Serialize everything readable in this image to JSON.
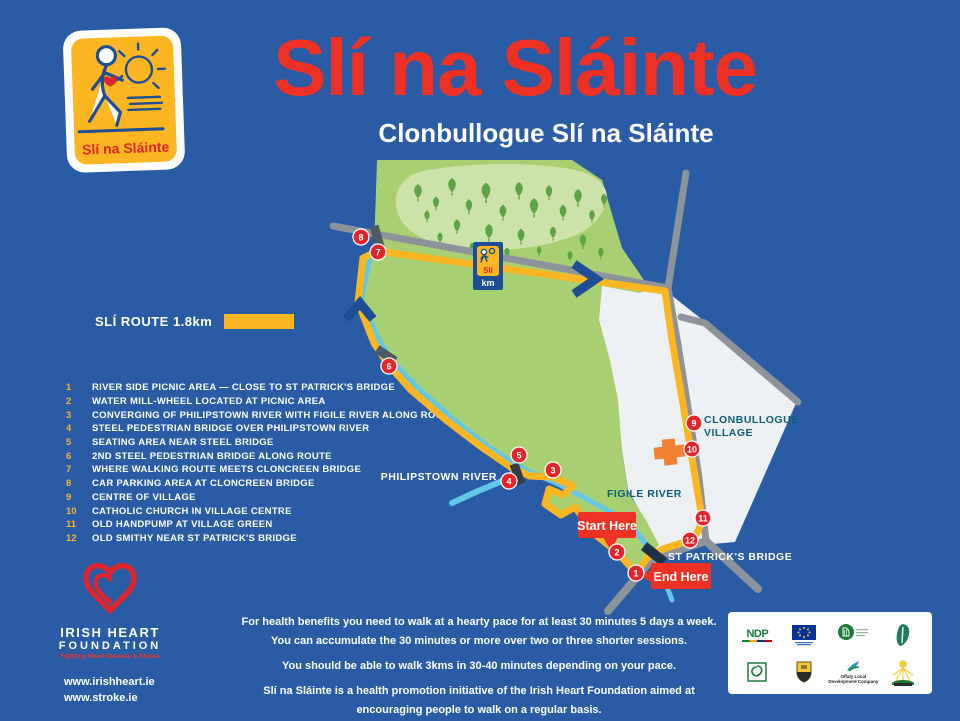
{
  "poster": {
    "title": "Slí na Sláinte",
    "subtitle": "Clonbullogue Slí na Sláinte",
    "brand_logo_caption": "Slí na Sláinte",
    "legend": {
      "route_label": "SLÍ ROUTE 1.8km"
    },
    "points": [
      {
        "num": "1",
        "label": "RIVER SIDE PICNIC AREA — CLOSE TO ST PATRICK'S BRIDGE"
      },
      {
        "num": "2",
        "label": "WATER MILL-WHEEL LOCATED AT PICNIC AREA"
      },
      {
        "num": "3",
        "label": "CONVERGING OF PHILIPSTOWN RIVER WITH FIGILE RIVER ALONG ROUTE"
      },
      {
        "num": "4",
        "label": "STEEL PEDESTRIAN BRIDGE OVER PHILIPSTOWN RIVER"
      },
      {
        "num": "5",
        "label": "SEATING AREA NEAR STEEL BRIDGE"
      },
      {
        "num": "6",
        "label": "2ND STEEL PEDESTRIAN BRIDGE ALONG ROUTE"
      },
      {
        "num": "7",
        "label": "WHERE WALKING ROUTE MEETS CLONCREEN BRIDGE"
      },
      {
        "num": "8",
        "label": "CAR PARKING AREA AT CLONCREEN BRIDGE"
      },
      {
        "num": "9",
        "label": "CENTRE OF VILLAGE"
      },
      {
        "num": "10",
        "label": "CATHOLIC CHURCH IN VILLAGE CENTRE"
      },
      {
        "num": "11",
        "label": "OLD HANDPUMP AT VILLAGE GREEN"
      },
      {
        "num": "12",
        "label": "OLD SMITHY NEAR ST PATRICK'S BRIDGE"
      }
    ],
    "map": {
      "markers": [
        "1",
        "2",
        "3",
        "4",
        "5",
        "6",
        "7",
        "8",
        "9",
        "10",
        "11",
        "12"
      ],
      "labels": {
        "philipstown": "PHILIPSTOWN RIVER",
        "figile": "FIGILE RIVER",
        "village_line1": "CLONBULLOGUE",
        "village_line2": "VILLAGE",
        "st_patricks": "ST PATRICK'S BRIDGE",
        "start": "Start Here",
        "end": "End Here",
        "km_sign_top": "Slí",
        "km_sign_bottom": "km"
      }
    },
    "footer_lines": [
      "For health benefits you need to walk at a hearty pace for at least 30 minutes 5 days a week.",
      "You can accumulate the 30 minutes or more over two or three shorter sessions.",
      "You should be able to walk 3kms in 30-40 minutes depending on your pace.",
      "Slí na Sláinte is a health promotion initiative of the Irish Heart Foundation aimed at",
      "encouraging people to walk on a regular basis."
    ],
    "ihf": {
      "name_line1": "IRISH HEART",
      "name_line2": "FOUNDATION",
      "tagline": "Fighting Heart Disease & Stroke",
      "url1": "www.irishheart.ie",
      "url2": "www.stroke.ie"
    },
    "partners": {
      "ndp": "NDP",
      "offaly_ldc": "Offaly Local Development Company"
    },
    "colors": {
      "background_blue": "#2a5ca6",
      "title_red": "#ee3124",
      "route_yellow": "#fbb622",
      "field_green": "#a8cf72",
      "grove_green": "#cbe2a8",
      "tree_green": "#5fa344",
      "road_grey": "#8d939b",
      "village_white": "#eef1f4",
      "river_cyan": "#63c7e8",
      "bridge_navy": "#1d4e96",
      "marker_red": "#e2242b",
      "teal_label": "#0d5e79",
      "church_orange": "#f08232"
    }
  }
}
